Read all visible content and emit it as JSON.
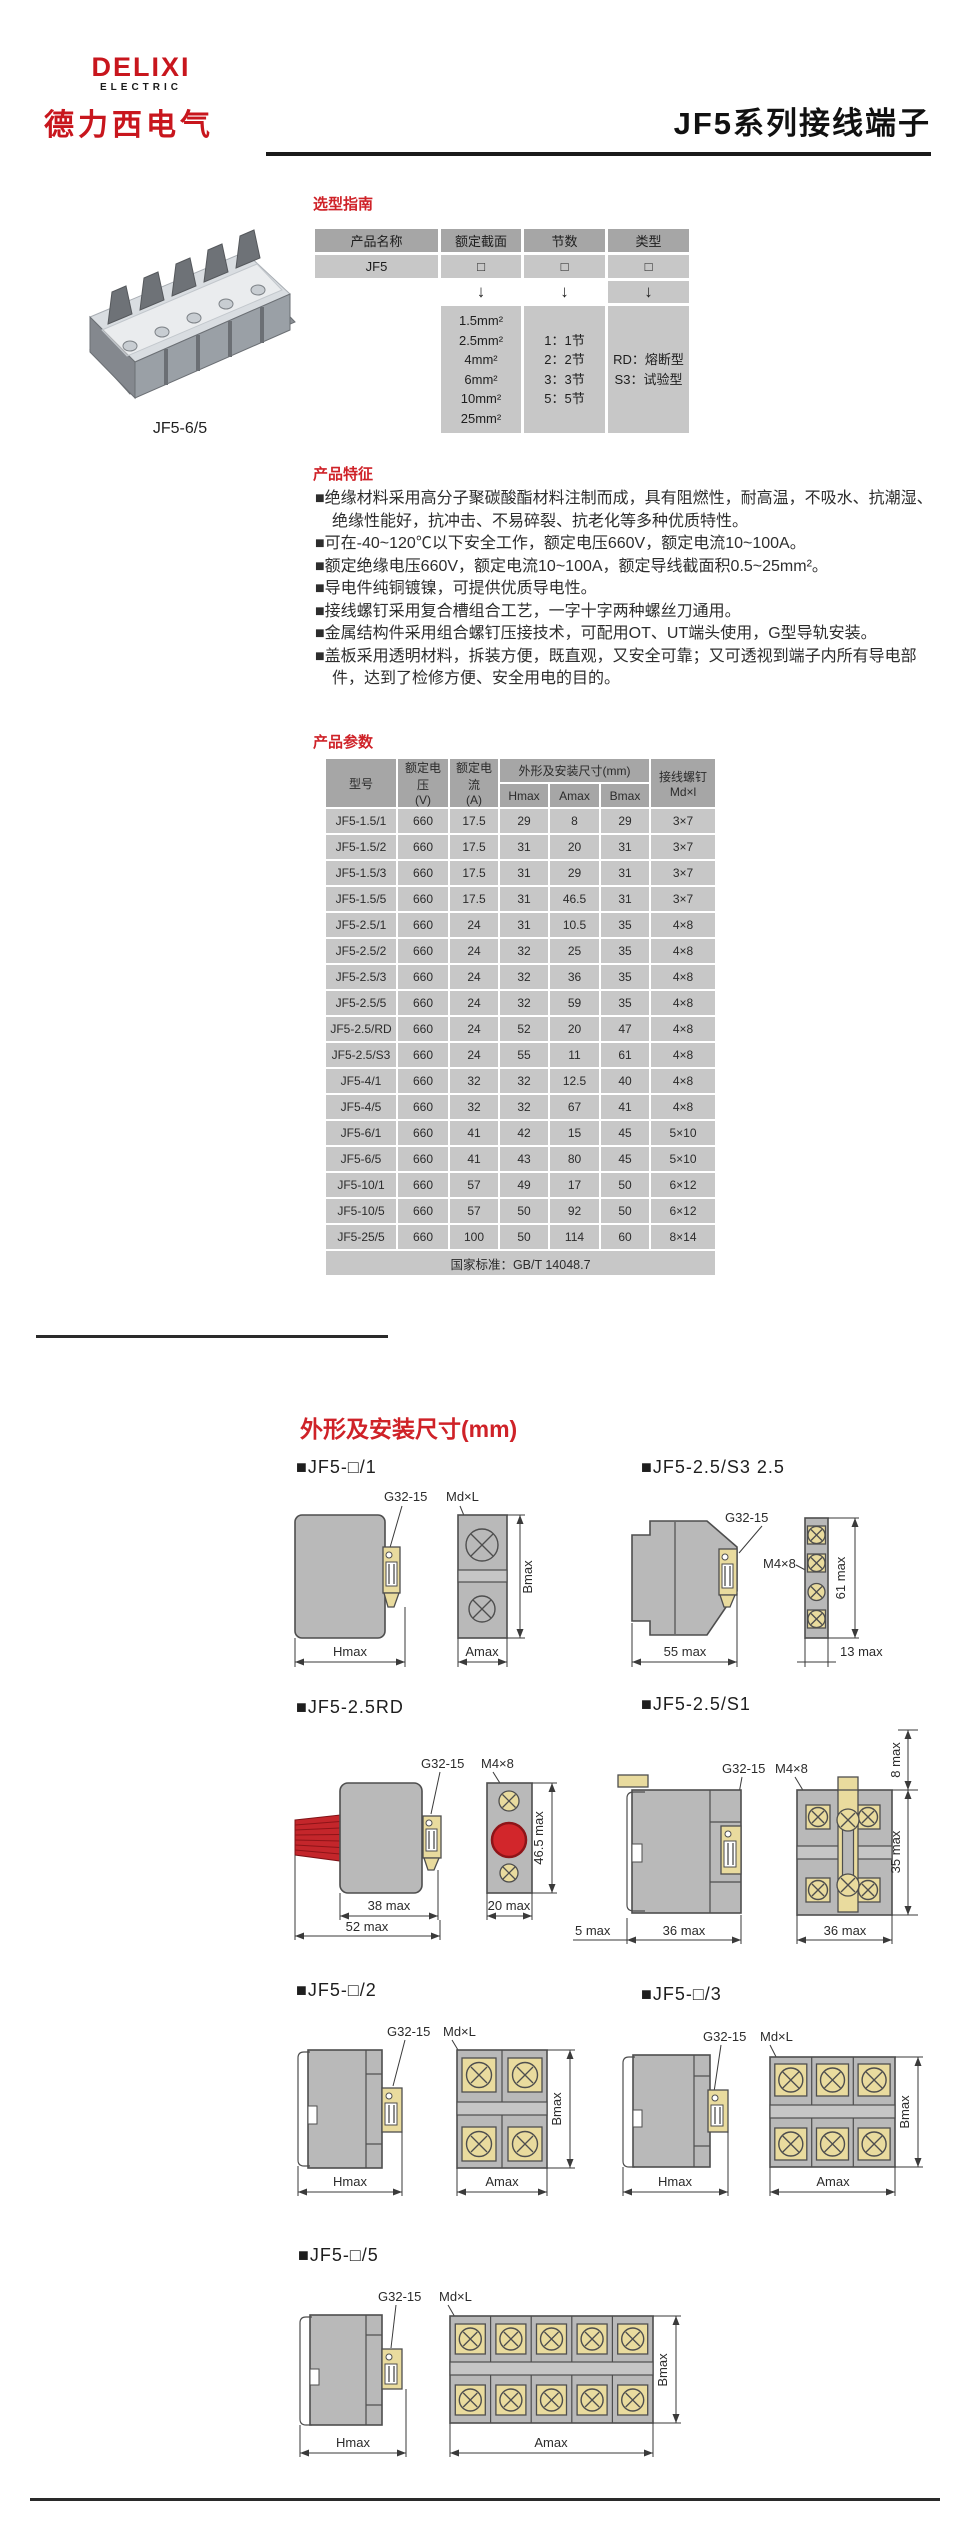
{
  "header": {
    "logo_main": "DELIXI",
    "logo_sub": "ELECTRIC",
    "logo_cn": "德力西电气",
    "page_title": "JF5系列接线端子"
  },
  "product_photo": {
    "caption": "JF5-6/5"
  },
  "selection_guide": {
    "heading": "选型指南",
    "columns": [
      "产品名称",
      "额定截面",
      "节数",
      "类型"
    ],
    "product_row": {
      "name": "JF5",
      "placeholder": "□"
    },
    "arrow": "↓",
    "options": {
      "cross_section": [
        "1.5mm²",
        "2.5mm²",
        "4mm²",
        "6mm²",
        "10mm²",
        "25mm²"
      ],
      "sections": [
        "1：1节",
        "2：2节",
        "3：3节",
        "5：5节"
      ],
      "types": [
        "RD：熔断型",
        "S3：试验型"
      ]
    }
  },
  "features": {
    "heading": "产品特征",
    "items": [
      "■绝缘材料采用高分子聚碳酸酯材料注制而成，具有阻燃性，耐高温，不吸水、抗潮湿、绝缘性能好，抗冲击、不易碎裂、抗老化等多种优质特性。",
      "■可在-40~120℃以下安全工作，额定电压660V，额定电流10~100A。",
      "■额定绝缘电压660V，额定电流10~100A，额定导线截面积0.5~25mm²。",
      "■导电件纯铜镀镍，可提供优质导电性。",
      "■接线螺钉采用复合槽组合工艺，一字十字两种螺丝刀通用。",
      "■金属结构件采用组合螺钉压接技术，可配用OT、UT端头使用，G型导轨安装。",
      "■盖板采用透明材料，拆装方便，既直观，又安全可靠；又可透视到端子内所有导电部件，达到了检修方便、安全用电的目的。"
    ]
  },
  "parameters": {
    "heading": "产品参数",
    "table": {
      "col_model": "型号",
      "col_voltage": "额定电压\n(V)",
      "col_current": "额定电流\n(A)",
      "col_dims": "外形及安装尺寸(mm)",
      "sub_cols": [
        "Hmax",
        "Amax",
        "Bmax"
      ],
      "col_screw": "接线螺钉\nMd×l",
      "rows": [
        [
          "JF5-1.5/1",
          "660",
          "17.5",
          "29",
          "8",
          "29",
          "3×7"
        ],
        [
          "JF5-1.5/2",
          "660",
          "17.5",
          "31",
          "20",
          "31",
          "3×7"
        ],
        [
          "JF5-1.5/3",
          "660",
          "17.5",
          "31",
          "29",
          "31",
          "3×7"
        ],
        [
          "JF5-1.5/5",
          "660",
          "17.5",
          "31",
          "46.5",
          "31",
          "3×7"
        ],
        [
          "JF5-2.5/1",
          "660",
          "24",
          "31",
          "10.5",
          "35",
          "4×8"
        ],
        [
          "JF5-2.5/2",
          "660",
          "24",
          "32",
          "25",
          "35",
          "4×8"
        ],
        [
          "JF5-2.5/3",
          "660",
          "24",
          "32",
          "36",
          "35",
          "4×8"
        ],
        [
          "JF5-2.5/5",
          "660",
          "24",
          "32",
          "59",
          "35",
          "4×8"
        ],
        [
          "JF5-2.5/RD",
          "660",
          "24",
          "52",
          "20",
          "47",
          "4×8"
        ],
        [
          "JF5-2.5/S3",
          "660",
          "24",
          "55",
          "11",
          "61",
          "4×8"
        ],
        [
          "JF5-4/1",
          "660",
          "32",
          "32",
          "12.5",
          "40",
          "4×8"
        ],
        [
          "JF5-4/5",
          "660",
          "32",
          "32",
          "67",
          "41",
          "4×8"
        ],
        [
          "JF5-6/1",
          "660",
          "41",
          "42",
          "15",
          "45",
          "5×10"
        ],
        [
          "JF5-6/5",
          "660",
          "41",
          "43",
          "80",
          "45",
          "5×10"
        ],
        [
          "JF5-10/1",
          "660",
          "57",
          "49",
          "17",
          "50",
          "6×12"
        ],
        [
          "JF5-10/5",
          "660",
          "57",
          "50",
          "92",
          "50",
          "6×12"
        ],
        [
          "JF5-25/5",
          "660",
          "100",
          "50",
          "114",
          "60",
          "8×14"
        ]
      ],
      "footer": "国家标准：GB/T 14048.7"
    }
  },
  "dimensions": {
    "heading": "外形及安装尺寸(mm)",
    "drawings": [
      {
        "label": "■JF5-□/1",
        "ann": {
          "clip": "G32-15",
          "screw": "Md×L",
          "h": "Hmax",
          "a": "Amax",
          "b": "Bmax"
        }
      },
      {
        "label": "■JF5-2.5/S3 2.5",
        "ann": {
          "clip": "G32-15",
          "screw": "M4×8",
          "b": "61 max",
          "h": "55 max",
          "a": "13 max"
        }
      },
      {
        "label": "■JF5-2.5RD",
        "ann": {
          "clip": "G32-15",
          "screw": "M4×8",
          "b": "46.5 max",
          "w1": "38 max",
          "w2": "20 max",
          "w3": "52 max"
        }
      },
      {
        "label": "■JF5-2.5/S1",
        "ann": {
          "clip": "G32-15",
          "screw": "M4×8",
          "t": "8 max",
          "b": "35 max",
          "w0": "5 max",
          "w1": "36 max",
          "w2": "36 max"
        }
      },
      {
        "label": "■JF5-□/2",
        "ann": {
          "clip": "G32-15",
          "screw": "Md×L",
          "h": "Hmax",
          "a": "Amax",
          "b": "Bmax"
        }
      },
      {
        "label": "■JF5-□/3",
        "ann": {
          "clip": "G32-15",
          "screw": "Md×L",
          "h": "Hmax",
          "a": "Amax",
          "b": "Bmax"
        }
      },
      {
        "label": "■JF5-□/5",
        "ann": {
          "clip": "G32-15",
          "screw": "Md×L",
          "h": "Hmax",
          "a": "Amax",
          "b": "Bmax"
        }
      }
    ]
  },
  "colors": {
    "accent_red": "#cf2228",
    "brand_red": "#c8161d",
    "table_header_gray": "#a6a6a6",
    "table_cell_gray": "#c7c7c7",
    "drawing_gray": "#b9b9b9",
    "brass": "#e9db9e",
    "wire_red": "#c4262b"
  }
}
